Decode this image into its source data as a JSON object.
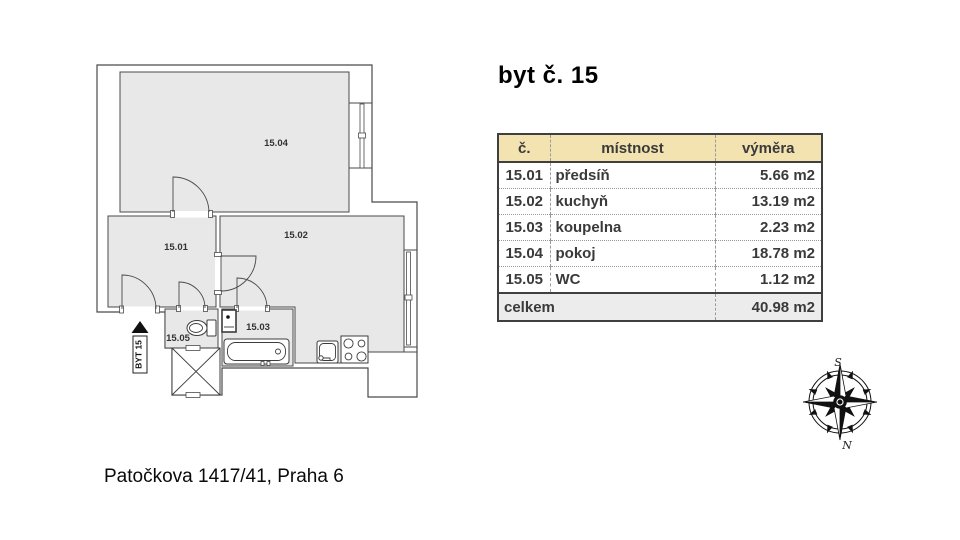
{
  "title": "byt č. 15",
  "address": "Patočkova 1417/41, Praha 6",
  "table": {
    "headers": [
      "č.",
      "místnost",
      "výměra"
    ],
    "rows": [
      [
        "15.01",
        "předsíň",
        "5.66 m2"
      ],
      [
        "15.02",
        "kuchyň",
        "13.19 m2"
      ],
      [
        "15.03",
        "koupelna",
        "2.23 m2"
      ],
      [
        "15.04",
        "pokoj",
        "18.78 m2"
      ],
      [
        "15.05",
        "WC",
        "1.12 m2"
      ]
    ],
    "total_label": "celkem",
    "total_value": "40.98 m2",
    "colors": {
      "header_bg": "#f3e3b0",
      "total_bg": "#ececec",
      "border": "#3f3f3f",
      "grid": "#9a9a9a",
      "text": "#3a3a3a"
    }
  },
  "plan": {
    "room_labels": {
      "r1501": "15.01",
      "r1502": "15.02",
      "r1503": "15.03",
      "r1504": "15.04",
      "r1505": "15.05"
    },
    "unit_marker": "BYT 15",
    "colors": {
      "room_fill": "#e8e8e8",
      "line": "#4a4a4a"
    }
  },
  "compass": {
    "top_label": "S",
    "bottom_label": "N"
  }
}
